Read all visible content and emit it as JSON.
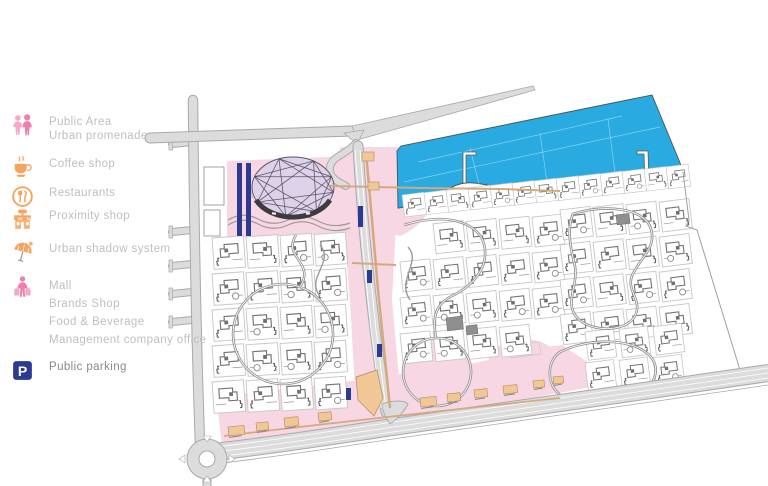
{
  "page": {
    "title": "Urban masterplan site map"
  },
  "legend": {
    "items": [
      {
        "id": "public-area",
        "icon": "people-icon",
        "lines": [
          "Public Area",
          "Urban promenade"
        ],
        "text_color": "#bfbfbf"
      },
      {
        "id": "coffee-shop",
        "icon": "coffee-cup-icon",
        "lines": [
          "Coffee  shop"
        ],
        "text_color": "#bfbfbf"
      },
      {
        "id": "restaurants",
        "icon": "fork-knife-circle-icon",
        "lines": [
          "Restaurants"
        ],
        "text_color": "#bfbfbf"
      },
      {
        "id": "proximity-shop",
        "icon": "storefront-icon",
        "lines": [
          "Proximity shop"
        ],
        "text_color": "#bfbfbf"
      },
      {
        "id": "urban-shadow-system",
        "icon": "parasol-icon",
        "lines": [
          "Urban shadow system"
        ],
        "text_color": "#bfbfbf"
      },
      {
        "id": "mall",
        "icon": "shopper-icon",
        "lines": [
          "Mall",
          "Brands Shop",
          "Food & Beverage",
          "Management company office"
        ],
        "text_color": "#bfbfbf"
      },
      {
        "id": "public-parking",
        "icon": "parking-icon",
        "lines": [
          "Public parking"
        ],
        "text_color": "#8a8a8a"
      }
    ],
    "icon_colors": {
      "pink": "#f6a8c9",
      "pink_deep": "#ef7fb3",
      "orange": "#f5a55f",
      "navy": "#2c3a92",
      "parking_letter": "P"
    }
  },
  "map": {
    "colors": {
      "water": "#29abe2",
      "water_edge": "#47555e",
      "pink": "#f8d7e4",
      "lavender": "#ded2ea",
      "road_fill": "#dcdcdc",
      "road_casing": "#a9a9a9",
      "tan": "#f0c795",
      "tan_shadow": "#b08c5f",
      "tan_path": "#d3a97e",
      "navy": "#2c3a92",
      "villa_outline": "#747474",
      "plot_line": "#c7c7c7",
      "loop_road": "#8f8f8f",
      "boundary": "#9aa0a4",
      "gray_building": "#8f8f8f",
      "dome_line": "#4a4550"
    },
    "features": [
      "marina-water",
      "beachfront-villas",
      "villa-clusters",
      "mall-dome",
      "central-promenade",
      "shop-strip",
      "ring-road",
      "roundabout"
    ]
  }
}
